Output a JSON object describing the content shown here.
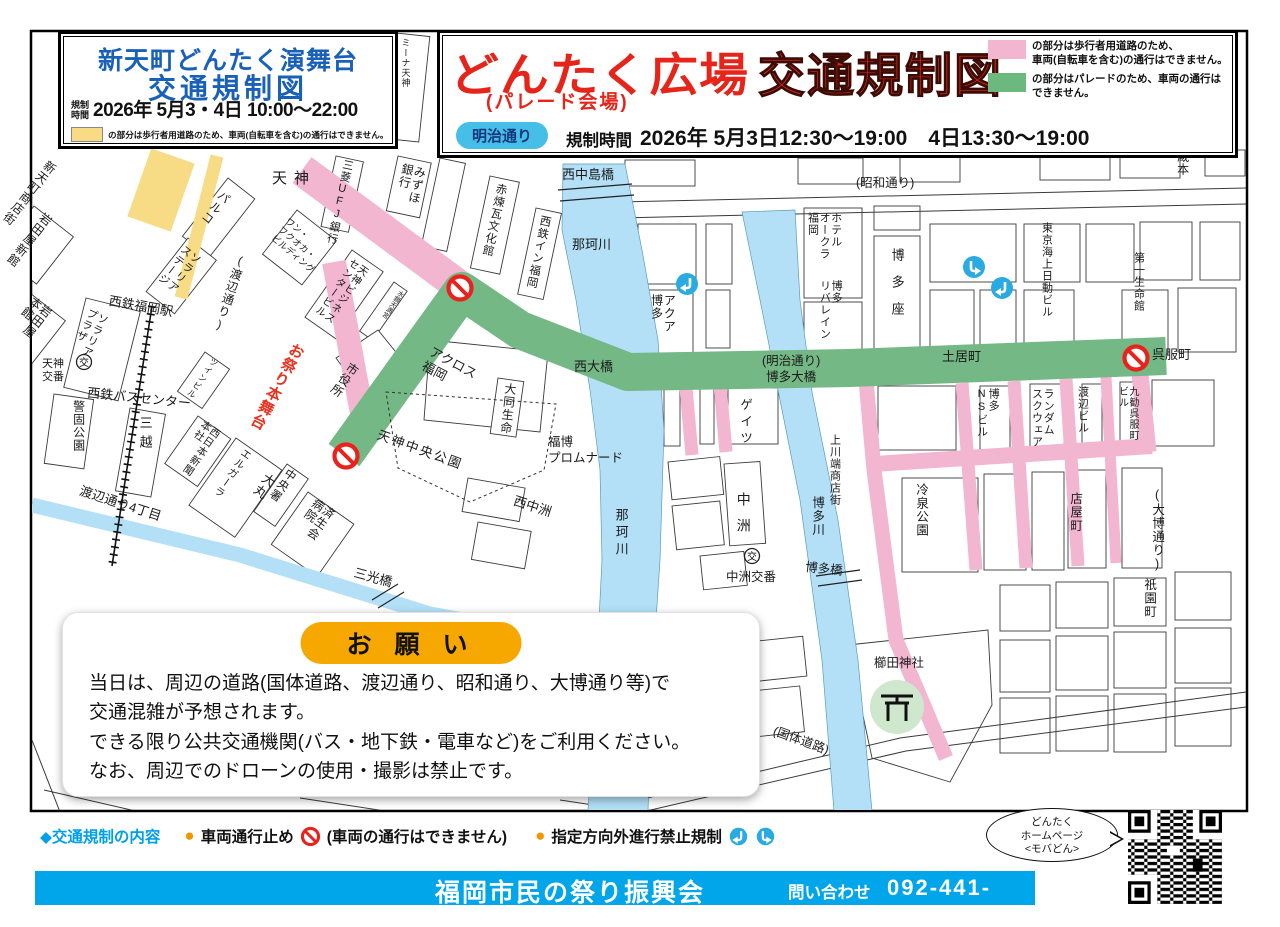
{
  "colors": {
    "title_blue": "#1961b8",
    "title_red": "#e62419",
    "pedestrian_pink": "#f2b6d0",
    "parade_green": "#74b886",
    "pedestrian_yellow": "#f8dc85",
    "river_blue": "#b3e0f7",
    "footer_blue": "#00a6e9",
    "badge_blue": "#45bfe8",
    "accent_orange": "#f29600",
    "notice_pill_orange": "#f6a800",
    "turn_icon_blue": "#29abe2",
    "no_entry_red": "#e8231e"
  },
  "stage_box": {
    "title_line1": "新天町どんたく演舞台",
    "title_line2": "交通規制図",
    "time_label": "規制\n時間",
    "time_value": "2026年 5月3・4日 10:00〜22:00",
    "legend_text": "の部分は歩行者用道路のため、車両(自転車を含む)の通行はできません。"
  },
  "main_header": {
    "title_main": "どんたく広場",
    "title_sub": "(パレード会場)",
    "title_right": "交通規制図",
    "badge": "明治通り",
    "time_label": "規制時間",
    "time_value": "2026年 5月3日12:30〜19:00　4日13:30〜19:00",
    "legend_pink": "の部分は歩行者用道路のため、\n車両(自転車を含む)の通行はできません。",
    "legend_green": "の部分はパレードのため、車両の通行は\nできません。"
  },
  "notice": {
    "title": "お 願 い",
    "body": "当日は、周辺の道路(国体道路、渡辺通り、昭和通り、大博通り等)で\n交通混雑が予想されます。\nできる限り公共交通機関(バス・地下鉄・電車など)をご利用ください。\nなお、周辺でのドローンの使用・撮影は禁止です。"
  },
  "legend_bar": {
    "heading": "◆交通規制の内容",
    "item1_bullet": "●",
    "item1_label": "車両通行止め",
    "item1_note": "(車両の通行はできません)",
    "item2_bullet": "●",
    "item2_label": "指定方向外進行禁止規制"
  },
  "footer": {
    "org": "福岡市民の祭り振興会",
    "contact_label": "問い合わせ",
    "phone": "092-441-1118",
    "bubble": "どんたく\nホームページ\n<モバどん>"
  },
  "map": {
    "koban": "交",
    "labels": [
      "新天町商店街",
      "岩田屋新館",
      "岩田屋\n本館",
      "天神",
      "パルコ",
      "ソラリア\nステージ",
      "(渡辺通り)",
      "ワン・\nフクオカ・\nビルディング",
      "西鉄福岡駅",
      "ソラリア\nプラザ",
      "天神\n交番",
      "西鉄バスセンター",
      "警固公園",
      "三越",
      "渡辺通り4丁目",
      "西日本新聞\n本社",
      "大丸",
      "エルガーラ",
      "中央署",
      "済生会\n病院",
      "市役所",
      "お祭り本舞台",
      "天神中央公園",
      "三光橋",
      "三菱UFJ銀行",
      "みずほ\n銀行",
      "赤煉瓦文化館",
      "西鉄イン福岡",
      "天神ビジネス\nセンタービル",
      "アクロス\n福岡",
      "西中島橋",
      "那珂川",
      "大同生命",
      "福博\nプロムナード",
      "西中洲",
      "西大橋",
      "(明治通り)\n博多大橋",
      "アクア\n博多",
      "(昭和通り)",
      "ホテル\nオークラ\n福岡",
      "博多\nリバレイン",
      "博多座",
      "東京海上日動ビル",
      "第一生命館",
      "蔵本",
      "土居町",
      "呉服町",
      "博多\nNSビル",
      "ランダム\nスクウェア",
      "渡辺ビル",
      "九勧呉服町\nビル",
      "冷泉公園",
      "店屋町",
      "(大博通り)",
      "祇園町",
      "ゲイツ",
      "中洲",
      "那珂川",
      "博多川",
      "上川端商店街",
      "博多橋",
      "中洲交番",
      "櫛田神社",
      "(国体道路)",
      "水鏡天満宮",
      "ツインビル",
      "ミーナ天神"
    ]
  }
}
